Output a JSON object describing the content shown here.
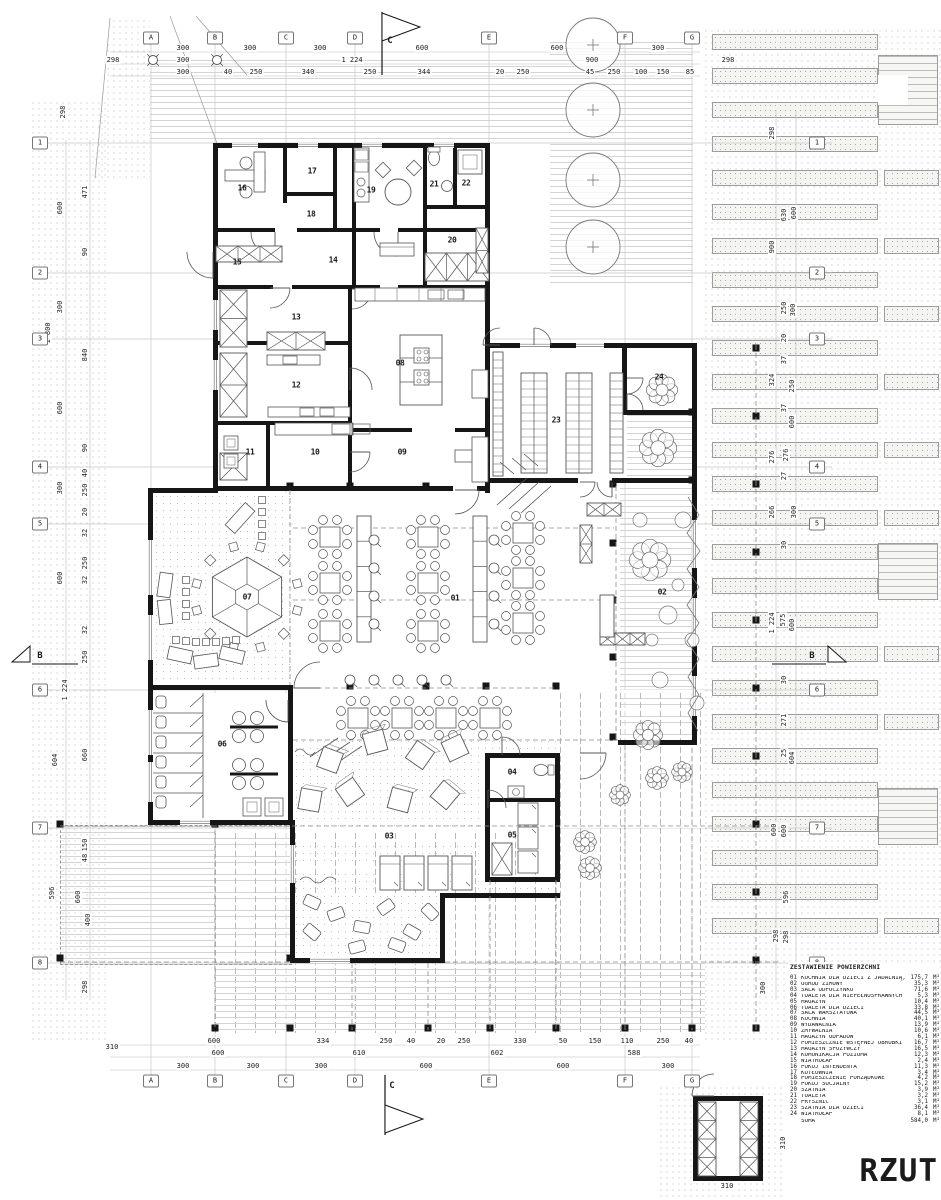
{
  "title": {
    "text": "RZUT"
  },
  "legend": {
    "title": "ZESTAWIENIE POWIERZCHNI",
    "unit": "M²",
    "items": [
      {
        "no": "01",
        "name": "KUCHNIA DLA DZIECI Z JADALNIĄ,",
        "area": "175,7"
      },
      {
        "no": "02",
        "name": "OGRÓD ZIMOWY",
        "area": "35,3"
      },
      {
        "no": "03",
        "name": "SALA ODPOCZYNKU",
        "area": "71,6"
      },
      {
        "no": "04",
        "name": "TOALETA DLA NIEPEŁNOSPRAWNYCH",
        "area": "5,3"
      },
      {
        "no": "05",
        "name": "MAGAZYN",
        "area": "10,4"
      },
      {
        "no": "06",
        "name": "TOALETA DLA DZIECI",
        "area": "33,8"
      },
      {
        "no": "07",
        "name": "SALA WARSZTATOWA",
        "area": "44,5"
      },
      {
        "no": "08",
        "name": "KUCHNIA",
        "area": "40,1"
      },
      {
        "no": "09",
        "name": "WYDAWALNIA",
        "area": "13,9"
      },
      {
        "no": "10",
        "name": "ZMYWALNIA",
        "area": "10,6"
      },
      {
        "no": "11",
        "name": "MAGAZYN ODPADÓW",
        "area": "6,1"
      },
      {
        "no": "12",
        "name": "POMIESZCZNIE WSTĘPNEJ OBRÓBKI",
        "area": "16,7"
      },
      {
        "no": "13",
        "name": "MAGAZYN SPOŻYWCZY",
        "area": "16,5"
      },
      {
        "no": "14",
        "name": "KOMUNIKACJA POZIOMA",
        "area": "12,3"
      },
      {
        "no": "15",
        "name": "WIATROŁAP",
        "area": "2,4"
      },
      {
        "no": "16",
        "name": "POKÓJ INTENDENTA",
        "area": "11,3"
      },
      {
        "no": "17",
        "name": "KOTŁOWNIA",
        "area": "3,4"
      },
      {
        "no": "18",
        "name": "POMIESZCZENIE PORZĄDKOWE",
        "area": "4,2"
      },
      {
        "no": "19",
        "name": "POKÓJ SOCJALNY",
        "area": "15,2"
      },
      {
        "no": "20",
        "name": "SZATNIA",
        "area": "3,9"
      },
      {
        "no": "21",
        "name": "TOALETA",
        "area": "3,2"
      },
      {
        "no": "22",
        "name": "PRYSZNIC",
        "area": "3,1"
      },
      {
        "no": "23",
        "name": "SZATNIA DLA DZIECI",
        "area": "36,4"
      },
      {
        "no": "24",
        "name": "WIATROŁAP",
        "area": "8,1"
      }
    ],
    "total": {
      "name": "SUMA",
      "area": "584,0"
    }
  },
  "grid": {
    "cols": [
      [
        "A",
        151
      ],
      [
        "B",
        215
      ],
      [
        "C",
        286
      ],
      [
        "D",
        355
      ],
      [
        "E",
        489
      ],
      [
        "F",
        625
      ],
      [
        "G",
        692
      ]
    ],
    "rows": [
      [
        "1",
        143
      ],
      [
        "2",
        273
      ],
      [
        "3",
        339
      ],
      [
        "4",
        467
      ],
      [
        "5",
        524
      ],
      [
        "6",
        690
      ],
      [
        "7",
        828
      ],
      [
        "8",
        963
      ]
    ]
  },
  "rooms": [
    [
      "01",
      455,
      598
    ],
    [
      "02",
      662,
      592
    ],
    [
      "03",
      389,
      836
    ],
    [
      "04",
      512,
      772
    ],
    [
      "05",
      512,
      835
    ],
    [
      "06",
      222,
      744
    ],
    [
      "07",
      247,
      597
    ],
    [
      "08",
      400,
      363
    ],
    [
      "09",
      402,
      452
    ],
    [
      "10",
      315,
      452
    ],
    [
      "11",
      250,
      452
    ],
    [
      "12",
      296,
      385
    ],
    [
      "13",
      296,
      317
    ],
    [
      "14",
      333,
      260
    ],
    [
      "15",
      237,
      262
    ],
    [
      "16",
      242,
      188
    ],
    [
      "17",
      312,
      171
    ],
    [
      "18",
      311,
      214
    ],
    [
      "19",
      371,
      190
    ],
    [
      "20",
      452,
      240
    ],
    [
      "21",
      434,
      184
    ],
    [
      "22",
      466,
      183
    ],
    [
      "23",
      556,
      420
    ],
    [
      "24",
      659,
      377
    ]
  ],
  "sections": [
    {
      "label": "C",
      "x": 390,
      "y": 41
    },
    {
      "label": "C",
      "x": 392,
      "y": 1086
    },
    {
      "label": "B",
      "x": 40,
      "y": 656
    },
    {
      "label": "B",
      "x": 812,
      "y": 656
    }
  ],
  "dims": [
    [
      "300",
      183,
      48,
      0
    ],
    [
      "300",
      250,
      48,
      0
    ],
    [
      "300",
      320,
      48,
      0
    ],
    [
      "600",
      422,
      48,
      0
    ],
    [
      "600",
      557,
      48,
      0
    ],
    [
      "300",
      658,
      48,
      0
    ],
    [
      "300",
      183,
      60,
      0
    ],
    [
      "1 224",
      352,
      60,
      0
    ],
    [
      "900",
      592,
      60,
      0
    ],
    [
      "298",
      113,
      60,
      0
    ],
    [
      "298",
      728,
      60,
      0
    ],
    [
      "300",
      183,
      72,
      0
    ],
    [
      "40",
      228,
      72,
      0
    ],
    [
      "250",
      256,
      72,
      0
    ],
    [
      "340",
      308,
      72,
      0
    ],
    [
      "250",
      370,
      72,
      0
    ],
    [
      "344",
      424,
      72,
      0
    ],
    [
      "20",
      500,
      72,
      0
    ],
    [
      "250",
      523,
      72,
      0
    ],
    [
      "45",
      590,
      72,
      0
    ],
    [
      "250",
      614,
      72,
      0
    ],
    [
      "100",
      641,
      72,
      0
    ],
    [
      "150",
      663,
      72,
      0
    ],
    [
      "85",
      690,
      72,
      0
    ],
    [
      "600",
      214,
      1041,
      0
    ],
    [
      "334",
      323,
      1041,
      0
    ],
    [
      "250",
      386,
      1041,
      0
    ],
    [
      "40",
      411,
      1041,
      0
    ],
    [
      "20",
      441,
      1041,
      0
    ],
    [
      "250",
      464,
      1041,
      0
    ],
    [
      "330",
      520,
      1041,
      0
    ],
    [
      "50",
      563,
      1041,
      0
    ],
    [
      "150",
      595,
      1041,
      0
    ],
    [
      "110",
      627,
      1041,
      0
    ],
    [
      "250",
      663,
      1041,
      0
    ],
    [
      "40",
      689,
      1041,
      0
    ],
    [
      "310",
      112,
      1047,
      0
    ],
    [
      "600",
      218,
      1053,
      0
    ],
    [
      "610",
      359,
      1053,
      0
    ],
    [
      "602",
      497,
      1053,
      0
    ],
    [
      "588",
      634,
      1053,
      0
    ],
    [
      "300",
      183,
      1066,
      0
    ],
    [
      "300",
      253,
      1066,
      0
    ],
    [
      "300",
      321,
      1066,
      0
    ],
    [
      "600",
      426,
      1066,
      0
    ],
    [
      "600",
      563,
      1066,
      0
    ],
    [
      "300",
      668,
      1066,
      0
    ],
    [
      "310",
      727,
      1186,
      0
    ],
    [
      "310",
      783,
      1143,
      1
    ],
    [
      "600",
      60,
      208,
      1
    ],
    [
      "300",
      60,
      307,
      1
    ],
    [
      "1 800",
      48,
      333,
      1
    ],
    [
      "600",
      60,
      408,
      1
    ],
    [
      "300",
      60,
      488,
      1
    ],
    [
      "600",
      60,
      578,
      1
    ],
    [
      "604",
      55,
      760,
      1
    ],
    [
      "596",
      52,
      893,
      1
    ],
    [
      "298",
      63,
      112,
      1
    ],
    [
      "471",
      85,
      192,
      1
    ],
    [
      "90",
      85,
      252,
      1
    ],
    [
      "840",
      85,
      355,
      1
    ],
    [
      "90",
      85,
      448,
      1
    ],
    [
      "40",
      85,
      473,
      1
    ],
    [
      "250",
      85,
      490,
      1
    ],
    [
      "20",
      85,
      512,
      1
    ],
    [
      "32",
      85,
      533,
      1
    ],
    [
      "250",
      85,
      563,
      1
    ],
    [
      "32",
      85,
      580,
      1
    ],
    [
      "32",
      85,
      630,
      1
    ],
    [
      "250",
      85,
      657,
      1
    ],
    [
      "1 224",
      65,
      690,
      1
    ],
    [
      "660",
      85,
      755,
      1
    ],
    [
      "150",
      85,
      845,
      1
    ],
    [
      "48",
      85,
      858,
      1
    ],
    [
      "600",
      78,
      897,
      1
    ],
    [
      "400",
      88,
      920,
      1
    ],
    [
      "298",
      85,
      987,
      1
    ],
    [
      "298",
      772,
      133,
      1
    ],
    [
      "900",
      772,
      247,
      1
    ],
    [
      "324",
      772,
      380,
      1
    ],
    [
      "276",
      772,
      457,
      1
    ],
    [
      "266",
      772,
      512,
      1
    ],
    [
      "1 224",
      772,
      623,
      1
    ],
    [
      "600",
      774,
      830,
      1
    ],
    [
      "298",
      776,
      936,
      1
    ],
    [
      "300",
      763,
      988,
      1
    ],
    [
      "630",
      784,
      215,
      1
    ],
    [
      "600",
      794,
      213,
      1
    ],
    [
      "250",
      784,
      308,
      1
    ],
    [
      "300",
      793,
      310,
      1
    ],
    [
      "20",
      784,
      338,
      1
    ],
    [
      "37",
      784,
      360,
      1
    ],
    [
      "250",
      792,
      386,
      1
    ],
    [
      "37",
      784,
      408,
      1
    ],
    [
      "600",
      792,
      422,
      1
    ],
    [
      "276",
      786,
      455,
      1
    ],
    [
      "27",
      784,
      476,
      1
    ],
    [
      "300",
      794,
      512,
      1
    ],
    [
      "30",
      784,
      545,
      1
    ],
    [
      "575",
      783,
      620,
      1
    ],
    [
      "600",
      792,
      625,
      1
    ],
    [
      "30",
      784,
      680,
      1
    ],
    [
      "271",
      784,
      720,
      1
    ],
    [
      "25",
      784,
      753,
      1
    ],
    [
      "604",
      792,
      758,
      1
    ],
    [
      "600",
      784,
      831,
      1
    ],
    [
      "596",
      786,
      897,
      1
    ],
    [
      "298",
      786,
      937,
      1
    ]
  ]
}
